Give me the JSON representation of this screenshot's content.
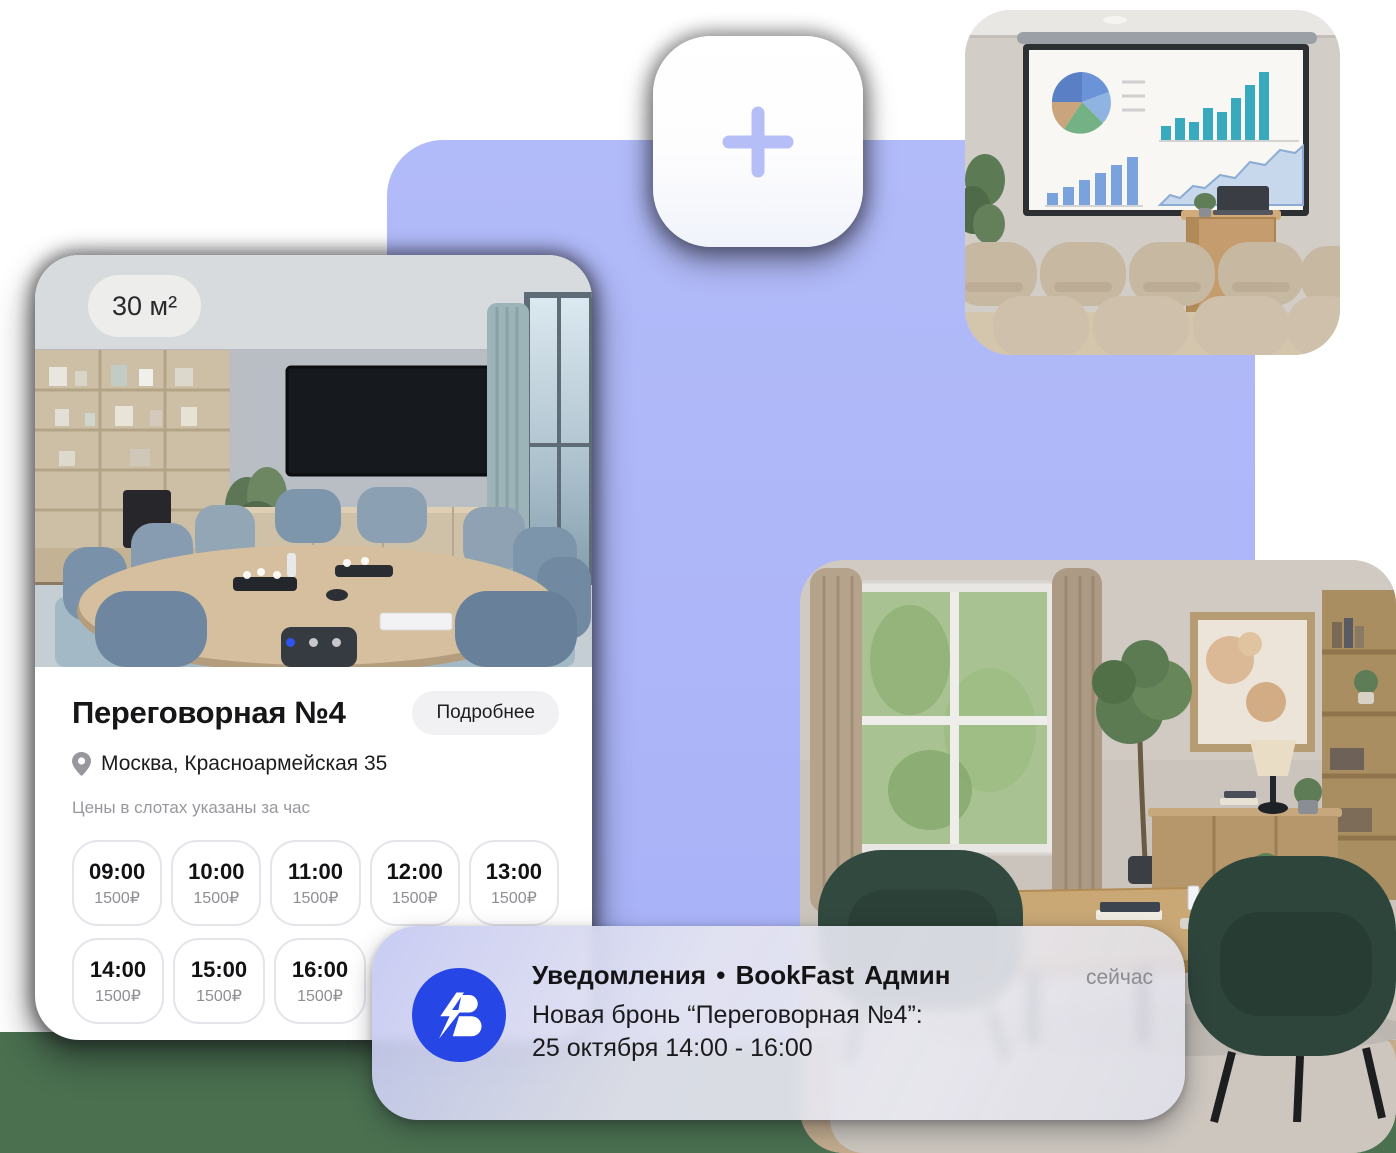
{
  "colors": {
    "accent_blue": "#2f55ee",
    "logo_blue": "#2746e6",
    "purple": "#aeb7f8",
    "green_band": "#4a7050"
  },
  "add_tile": {
    "icon": "plus"
  },
  "room_card": {
    "area_badge": "30 м²",
    "carousel": {
      "dots": 3,
      "active_index": 0
    },
    "title": "Переговорная №4",
    "details_button": "Подробнее",
    "location": "Москва, Красноармейская 35",
    "price_note": "Цены в слотах указаны за час",
    "slots_row1": [
      {
        "time": "09:00",
        "price": "1500₽"
      },
      {
        "time": "10:00",
        "price": "1500₽"
      },
      {
        "time": "11:00",
        "price": "1500₽"
      },
      {
        "time": "12:00",
        "price": "1500₽"
      },
      {
        "time": "13:00",
        "price": "1500₽"
      }
    ],
    "slots_row2": [
      {
        "time": "14:00",
        "price": "1500₽"
      },
      {
        "time": "15:00",
        "price": "1500₽"
      },
      {
        "time": "16:00",
        "price": "1500₽"
      },
      {
        "time": "",
        "price": ""
      }
    ]
  },
  "notification": {
    "title": "Уведомления • BookFast Админ",
    "time": "сейчас",
    "body_line1": "Новая бронь “Переговорная №4”:",
    "body_line2": "25 октября 14:00 - 16:00"
  }
}
